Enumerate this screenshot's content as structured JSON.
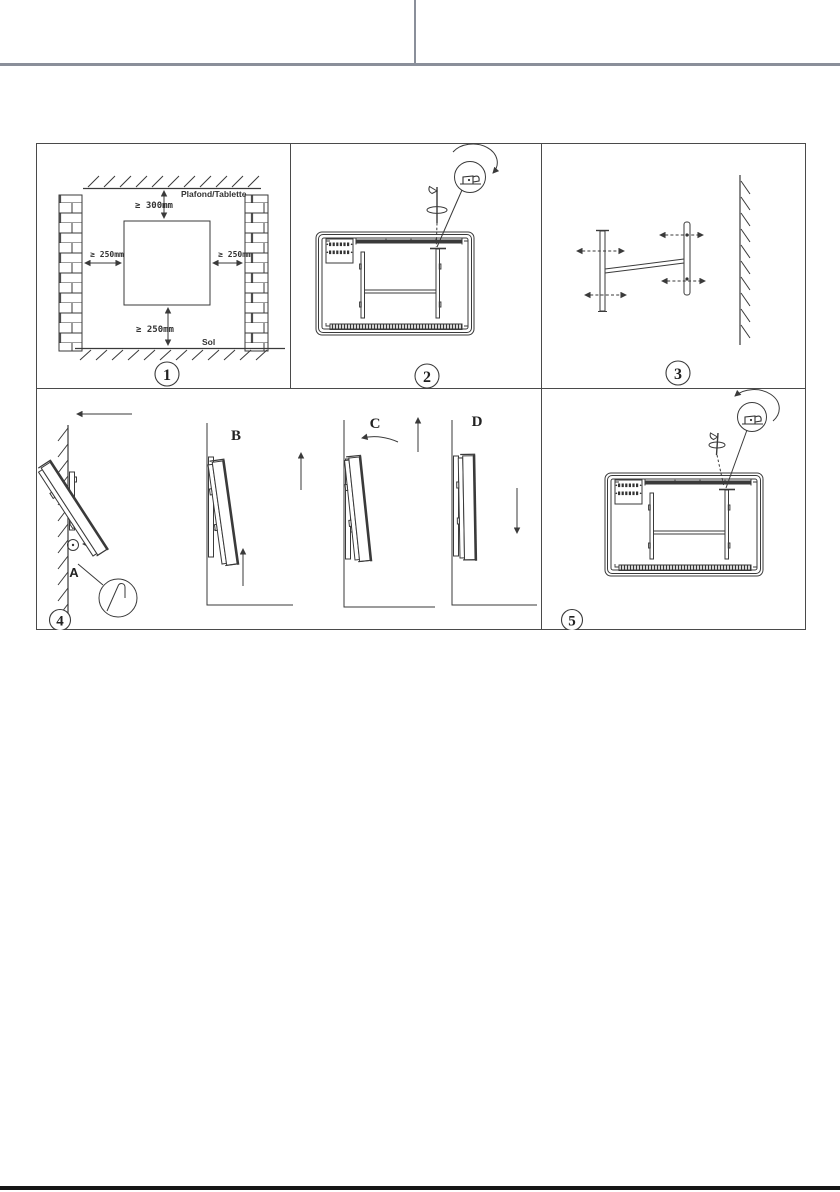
{
  "page": {
    "background": "#ffffff",
    "line_color": "#3a3a3a",
    "header_divider_color": "#8a8f9a",
    "footer_bar_color": "#161616"
  },
  "figure": {
    "title": "heater wall-mounting installation steps",
    "panel1": {
      "number": "1",
      "ceiling_label": "Plafond/Tablette",
      "floor_label": "Sol",
      "clearance_top": "≥ 300mm",
      "clearance_left": "≥ 250mm",
      "clearance_right": "≥ 250mm",
      "clearance_bottom": "≥ 250mm"
    },
    "panel2": {
      "number": "2"
    },
    "panel3": {
      "number": "3"
    },
    "panel4": {
      "number": "4",
      "labels": {
        "a": "A",
        "b": "B",
        "c": "C",
        "d": "D"
      }
    },
    "panel5": {
      "number": "5"
    }
  }
}
